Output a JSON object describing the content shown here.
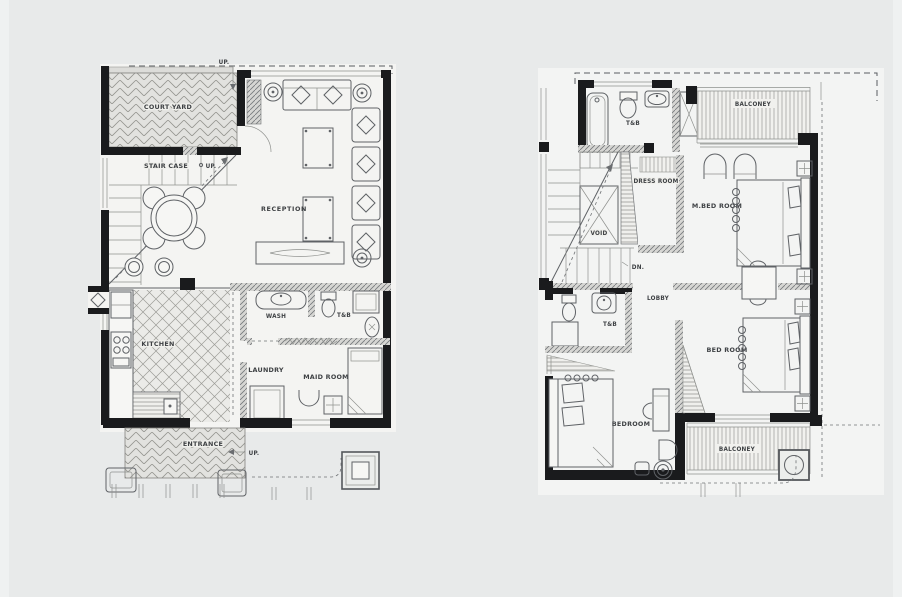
{
  "palette": {
    "background": "#e8eaea",
    "paper": "#f4f4f2",
    "wall": "#1a1b1d",
    "line": "#5f6266",
    "hatch": "#8f918e"
  },
  "ground_floor_plan": {
    "labels": {
      "up_top": "UP.",
      "court_yard": "COURT YARD",
      "stair_case": "STAIR CASE",
      "up_stair": "UP.",
      "reception": "RECEPTION",
      "kitchen": "KITCHEN",
      "wash": "WASH",
      "toilet_bath": "T&B",
      "laundry": "LAUNDRY",
      "maid_room": "MAID ROOM",
      "entrance": "ENTRANCE",
      "up_entrance": "UP."
    }
  },
  "second_floor_plan": {
    "labels": {
      "toilet_bath_main": "T&B",
      "balcony_top": "BALCONEY",
      "dress_room": "DRESS ROOM",
      "void": "VOID",
      "down": "DN.",
      "master_bed_room": "M.BED ROOM",
      "lobby": "LOBBY",
      "toilet_bath_small": "T&B",
      "bed_room": "BED ROOM",
      "bedroom": "BEDROOM",
      "balcony_bottom": "BALCONEY"
    }
  }
}
